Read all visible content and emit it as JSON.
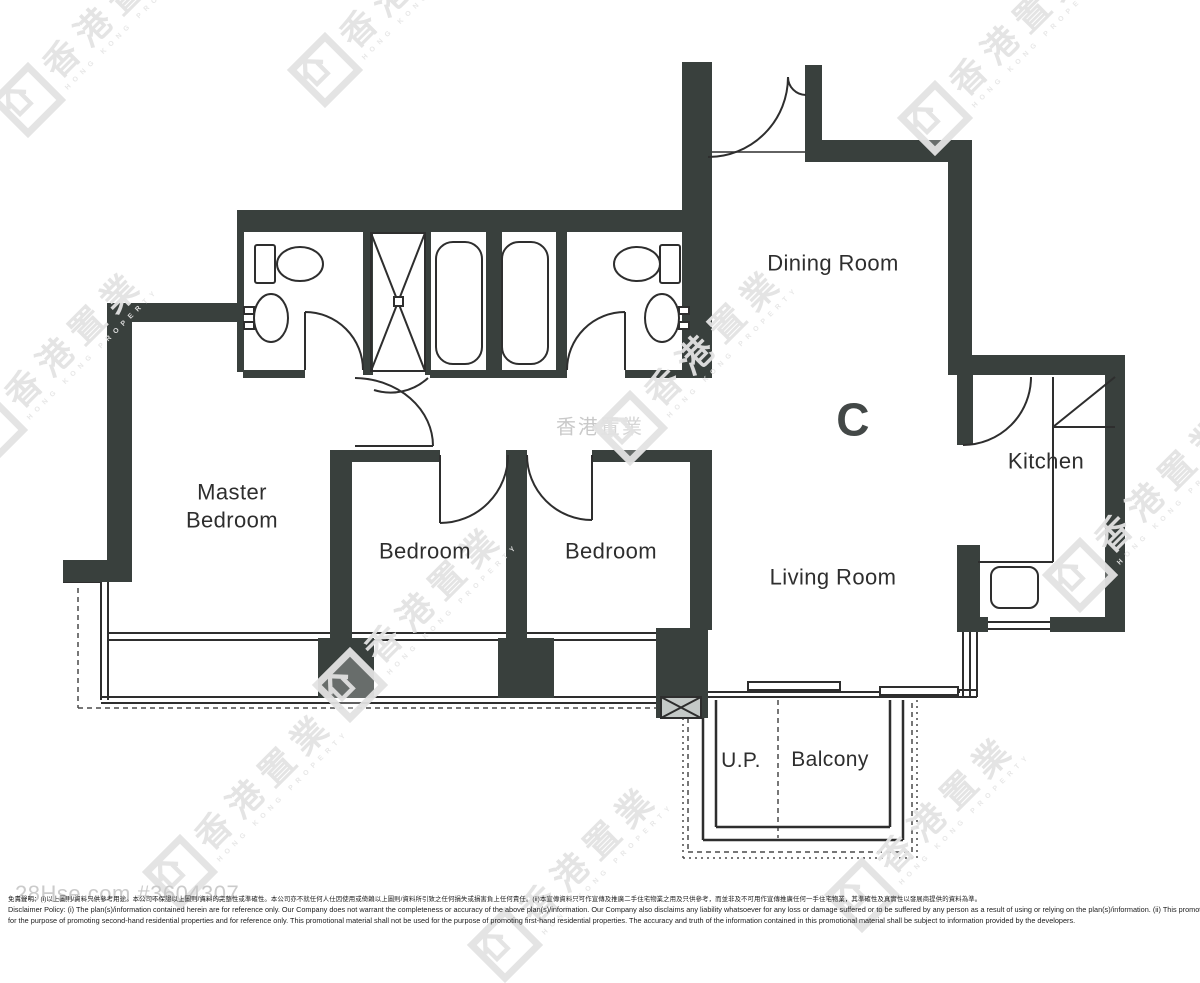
{
  "brand": {
    "name_zh": "香港置業",
    "name_en": "HONG KONG PROPERTY"
  },
  "floor_plan": {
    "unit_label": "C",
    "wall_color": "#39403d",
    "line_color": "#2e2e2e",
    "room_labels": [
      {
        "id": "master-bedroom",
        "text": "Master\nBedroom",
        "x": 232,
        "y": 506,
        "size": 22,
        "bold": false
      },
      {
        "id": "bedroom-1",
        "text": "Bedroom",
        "x": 425,
        "y": 551,
        "size": 22,
        "bold": false
      },
      {
        "id": "bedroom-2",
        "text": "Bedroom",
        "x": 611,
        "y": 551,
        "size": 22,
        "bold": false
      },
      {
        "id": "dining-room",
        "text": "Dining Room",
        "x": 833,
        "y": 263,
        "size": 22,
        "bold": false
      },
      {
        "id": "living-room",
        "text": "Living Room",
        "x": 833,
        "y": 577,
        "size": 22,
        "bold": false
      },
      {
        "id": "kitchen",
        "text": "Kitchen",
        "x": 1046,
        "y": 461,
        "size": 22,
        "bold": false
      },
      {
        "id": "utility-platform",
        "text": "U.P.",
        "x": 741,
        "y": 761,
        "size": 21,
        "bold": false
      },
      {
        "id": "balcony",
        "text": "Balcony",
        "x": 830,
        "y": 760,
        "size": 21,
        "bold": false
      },
      {
        "id": "unit-letter",
        "text": "C",
        "x": 853,
        "y": 420,
        "size": 46,
        "bold": true
      }
    ]
  },
  "watermarks": {
    "logo_text": "香港置業",
    "logo_subtext": "HONG KONG PROPERTY",
    "color": "#e3e3e3",
    "positions": [
      {
        "x": 28,
        "y": 100
      },
      {
        "x": 325,
        "y": 70
      },
      {
        "x": 935,
        "y": 118
      },
      {
        "x": -10,
        "y": 430
      },
      {
        "x": 630,
        "y": 428
      },
      {
        "x": 350,
        "y": 685
      },
      {
        "x": 1080,
        "y": 575
      },
      {
        "x": 180,
        "y": 872
      },
      {
        "x": 862,
        "y": 895
      },
      {
        "x": 505,
        "y": 945
      }
    ],
    "center_text": {
      "text": "香港置業",
      "x": 600,
      "y": 425
    }
  },
  "footer": {
    "listing_id": "28Hse.com #3604307",
    "disclaimer_zh": "免責聲明：(i)以上圖則/資料只供參考用途。本公司不保證以上圖則/資料的完整性或準確性。本公司亦不就任何人仕因使用或倚賴以上圖則/資料所引致之任何損失或損害負上任何責任。(ii)本宣傳資料只可作宣傳及推廣二手住宅物業之用及只供參考，而並非及不可用作宣傳推廣任何一手住宅物業，其準確性及真實性以發展商提供的資料為準。",
    "disclaimer_en_line1": "Disclaimer Policy: (i) The plan(s)/information contained herein are for reference only. Our Company does not warrant the completeness or accuracy of the above plan(s)/information. Our Company also disclaims any liability whatsoever for any loss or damage suffered or to be suffered by any person as a result of using or relying on the plan(s)/information. (ii) This promotional material is",
    "disclaimer_en_line2": "for the purpose of promoting second-hand residential properties and for reference only. This promotional material shall not be used for the purpose of promoting first-hand residential properties. The accuracy and truth of the information contained in this promotional material shall be subject to information provided by the developers."
  }
}
